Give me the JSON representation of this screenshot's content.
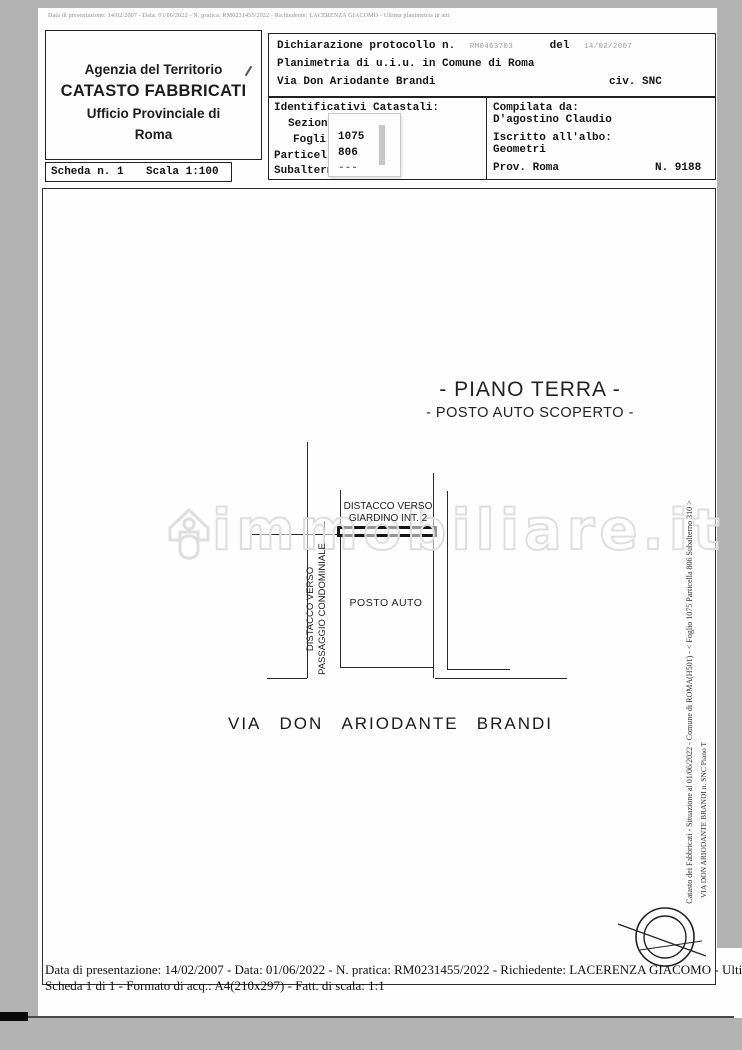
{
  "top_note": "Data di presentazione: 14/02/2007 - Data: 01/06/2022 - N. pratica: RM0231455/2022 - Richiedente: LACERENZA GIACOMO - Ultima planimetria in atti",
  "header": {
    "agency_line1": "Agenzia del Territorio",
    "agency_line2": "CATASTO FABBRICATI",
    "agency_line3": "Ufficio Provinciale di",
    "agency_line4": "Roma",
    "scheda_label": "Scheda n. 1",
    "scala_label": "Scala 1:100"
  },
  "declaration": {
    "protocol_label": "Dichiarazione protocollo n.",
    "protocol_number": "RM0463703",
    "del_label": "del",
    "protocol_date": "14/02/2007",
    "line2": "Planimetria di u.i.u. in Comune di Roma",
    "street": "Via Don Ariodante Brandi",
    "civ": "civ. SNC"
  },
  "catastali": {
    "title": "Identificativi Catastali:",
    "row_sezione": "Sezion",
    "row_foglio": "Fogli",
    "row_particella": "Particell",
    "row_subalterno": "Subaltern",
    "values": [
      "1075",
      "806",
      "---"
    ]
  },
  "compilata": {
    "title": "Compilata da:",
    "name": "D'agostino Claudio",
    "albo_label": "Iscritto all'albo:",
    "albo_value": "Geometri",
    "prov": "Prov. Roma",
    "number": "N. 9188"
  },
  "plan": {
    "title1": "- PIANO TERRA -",
    "title2": "- POSTO AUTO SCOPERTO -",
    "giardino_line1": "DISTACCO VERSO",
    "giardino_line2": "GIARDINO INT. 2",
    "passaggio_line1": "DISTACCO VERSO",
    "passaggio_line2": "PASSAGGIO CONDOMINIALE",
    "room_label": "POSTO AUTO",
    "street_words": [
      "VIA",
      "DON",
      "ARIODANTE",
      "BRANDI"
    ]
  },
  "watermark": {
    "text": "immobiliare.it"
  },
  "side_notes": {
    "line1": "Catasto dei Fabbricati - Situazione al 01/06/2022 - Comune di ROMA(H501) - < Foglio 1075 Particella 806 Subalterno 310 >",
    "line2": "VIA DON ARIODANTE BRANDI n. SNC Piano T"
  },
  "footer": {
    "line1": "Data di presentazione: 14/02/2007 - Data: 01/06/2022 - N. pratica: RM0231455/2022 - Richiedente: LACERENZA GIACOMO - Ultima plani",
    "line2": "Scheda 1 di 1 - Formato di acq.: A4(210x297) - Fatt. di scala: 1:1"
  },
  "colors": {
    "paper": "#fefefe",
    "scan_bg": "#b3b3b3",
    "ink": "#1a1a1a",
    "watermark": "#dedede"
  }
}
